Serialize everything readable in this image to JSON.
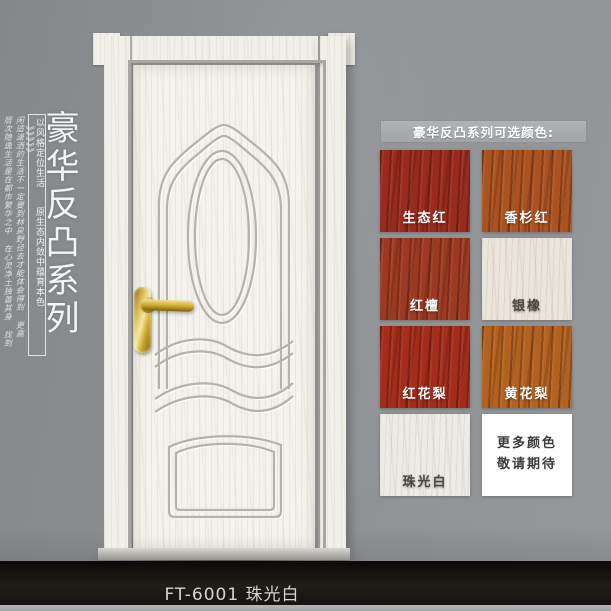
{
  "poster": {
    "series_title_vertical": "豪华反凸系列",
    "slogan_line_1": "以风格定位生活",
    "slogan_line_2": "原生态内敛中蕴育本色",
    "slogan_chevrons": "》》》》》",
    "script_text_1": "闲适潇洒的生活不一定要到林泉野径去才能体会得到 更高",
    "script_text_2": "层次隐逸生活是在都市繁华之中 在心灵净土独善其身 找到",
    "model_caption": "FT-6001 珠光白"
  },
  "swatch_panel": {
    "header": "豪华反凸系列可选颜色:",
    "swatches": [
      {
        "label": "生态红",
        "color": "#992a1e",
        "text_color": "#ffffff",
        "grain": "dark"
      },
      {
        "label": "香杉红",
        "color": "#aa5320",
        "text_color": "#ffffff",
        "grain": "dark"
      },
      {
        "label": "红檀",
        "color": "#9c3a21",
        "text_color": "#ffffff",
        "grain": "dark"
      },
      {
        "label": "银橡",
        "color": "#eae6db",
        "text_color": "#4a463f",
        "grain": "light"
      },
      {
        "label": "红花梨",
        "color": "#a32c1b",
        "text_color": "#ffffff",
        "grain": "dark"
      },
      {
        "label": "黄花梨",
        "color": "#b26220",
        "text_color": "#ffffff",
        "grain": "dark"
      },
      {
        "label": "珠光白",
        "color": "#edebe6",
        "text_color": "#4a463f",
        "grain": "light"
      },
      {
        "label": "更多颜色\n敬请期待",
        "color": "#ffffff",
        "text_color": "#3c3c3c",
        "grain": "none",
        "placeholder": true
      }
    ]
  },
  "colors": {
    "wall": "#8d9093",
    "floor": "#171411",
    "door_white": "#f3f1eb",
    "handle_gold": "#d4af37",
    "header_bar": "#a9acaf"
  }
}
